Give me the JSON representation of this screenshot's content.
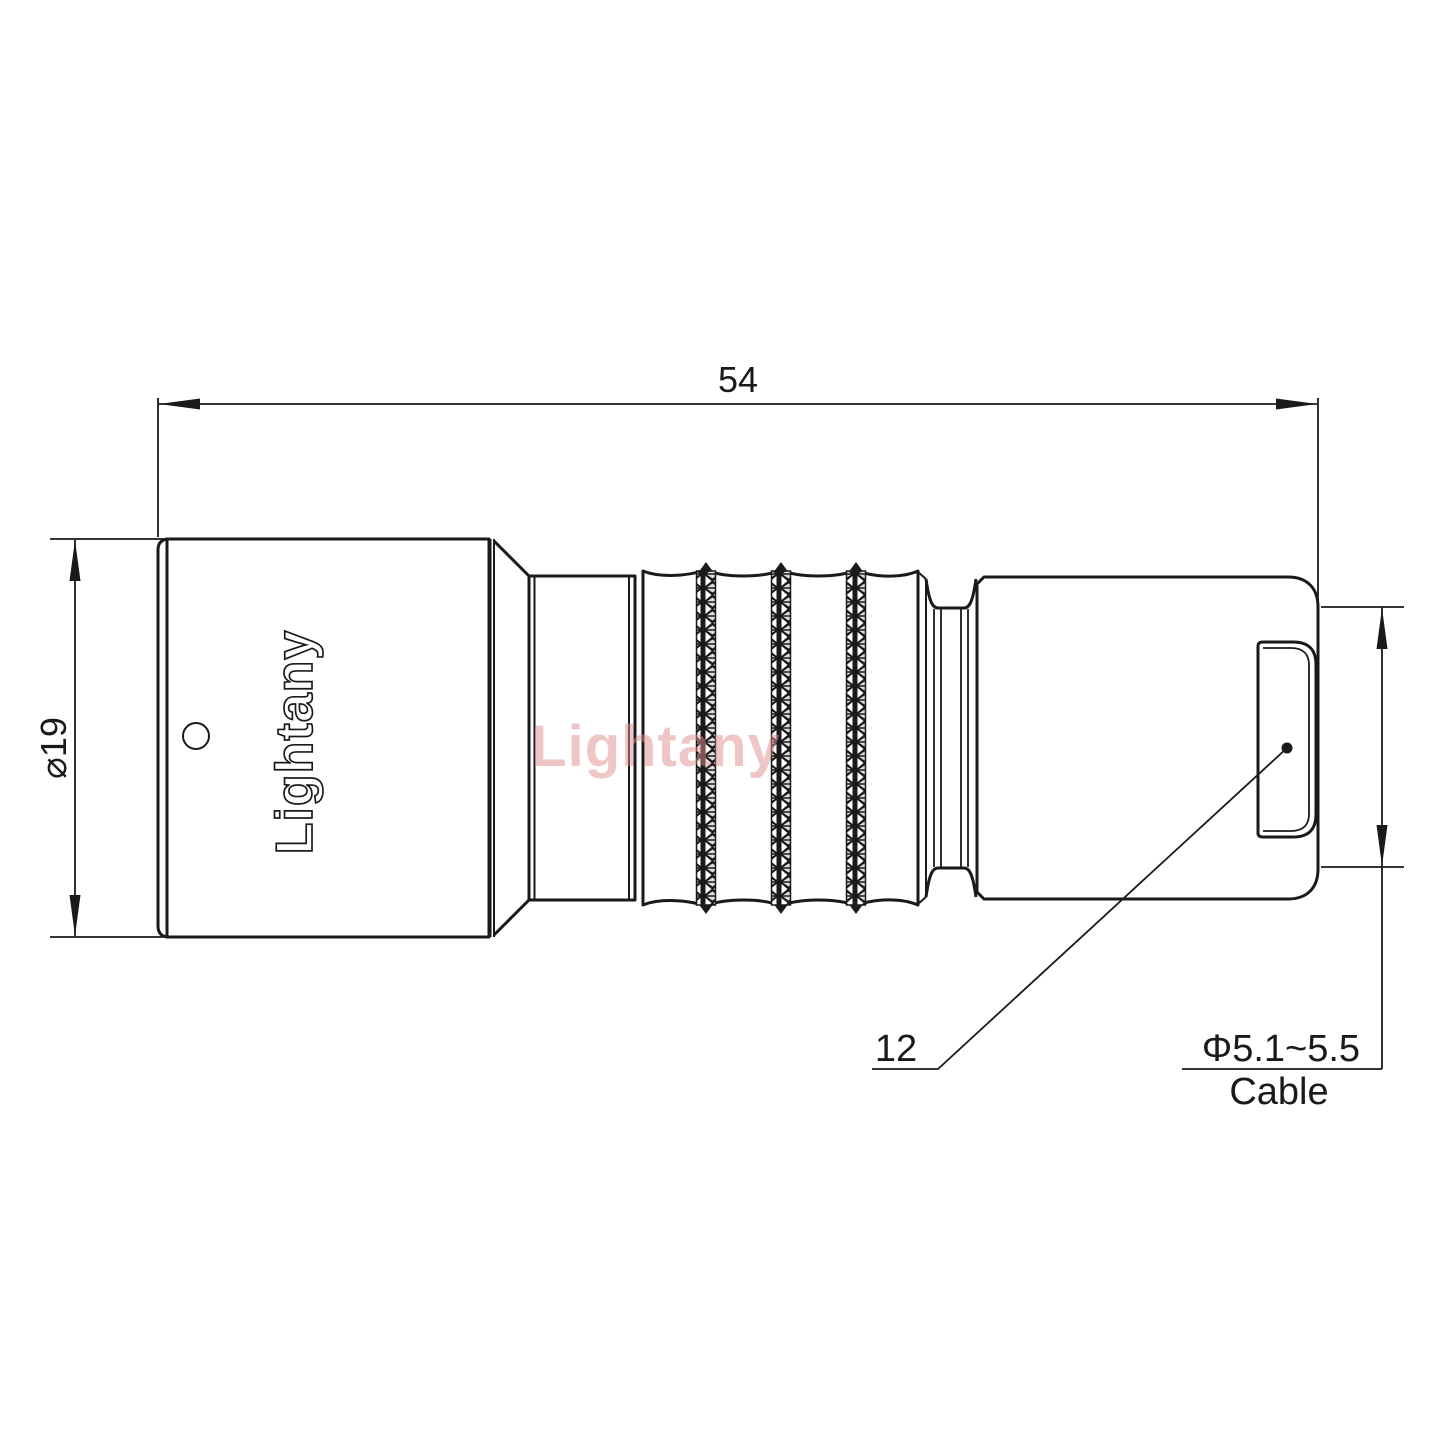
{
  "drawing": {
    "watermark_text": "Lightany",
    "body_engraving": "Lightany",
    "dimensions": {
      "overall_length": "54",
      "body_diameter": "⌀19",
      "rear_nut_length": "12",
      "cable_diameter_range": "Φ5.1~5.5",
      "cable_caption": "Cable"
    },
    "colors": {
      "line": "#1a1a1a",
      "background": "#ffffff",
      "watermark": "#e08f8f"
    }
  }
}
